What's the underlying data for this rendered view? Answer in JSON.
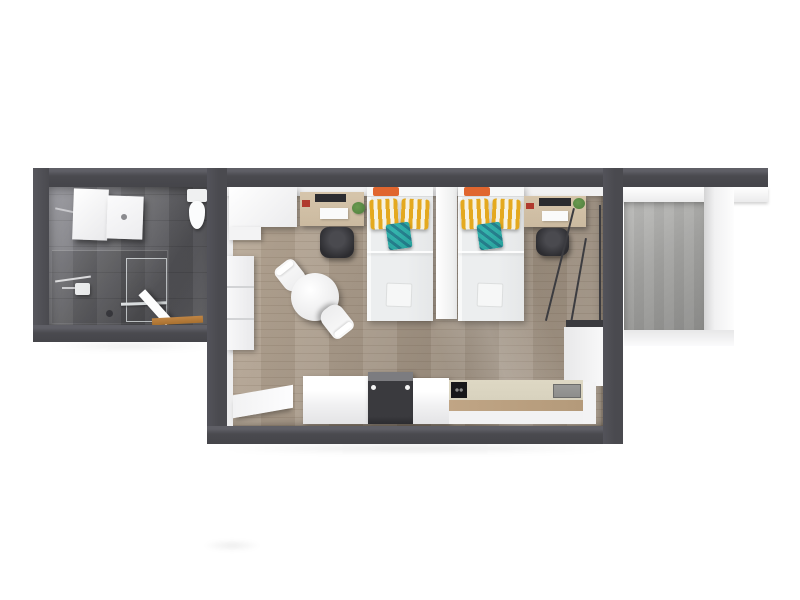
{
  "scene": {
    "type": "3d-floorplan-top-view",
    "background": "#ffffff"
  },
  "colors": {
    "wall": "#4a4a4f",
    "wall-top-edge": "#5f5f66",
    "bath-floor": "#6b6b6f",
    "wood-floor": "#a99b8b",
    "balcony-floor": "#a3a3a1",
    "bedding": "#eceeef",
    "pillow-yellow": "#e4a91f",
    "pillow-cream": "#f6f2e2",
    "cushion-teal": "#28a09b",
    "accent-orange": "#e0662f",
    "desk-wood": "#cbbaa0",
    "chair-dark": "#2c2c30",
    "appliance-dark": "#3a3a3e",
    "counter-cream": "#d8d2be",
    "counter-wood": "#b49a7a",
    "threshold-wood": "#a8702f",
    "plant-green": "#4e7d3c",
    "sink-gray": "#8e8e8c",
    "glass-frame": "#3c3c40"
  },
  "rooms": {
    "bathroom": {
      "label": "bathroom",
      "floor": "dark-gray-tile",
      "fixtures": [
        "vanity-cabinet",
        "washbasin",
        "toilet",
        "walk-in-shower",
        "shower-glass-panel",
        "shower-head",
        "towel-bar",
        "floor-drain",
        "entry-door",
        "wood-threshold"
      ]
    },
    "living_area": {
      "label": "living-sleeping-area",
      "floor": "light-oak-plank",
      "furniture": [
        "wardrobe",
        "wall-shelf",
        "desk",
        "office-chair",
        "single-bed",
        "bed-divider-panel",
        "single-bed",
        "desk",
        "office-chair",
        "round-dining-table",
        "dining-chair",
        "dining-chair",
        "side-table",
        "kitchen-cabinet",
        "oven",
        "kitchen-cabinet",
        "cooktop",
        "kitchen-sink",
        "kitchen-counter",
        "sliding-glass-door"
      ]
    },
    "balcony": {
      "label": "balcony",
      "floor": "gray-concrete",
      "features": [
        "white-parapet",
        "white-ledge"
      ]
    }
  }
}
